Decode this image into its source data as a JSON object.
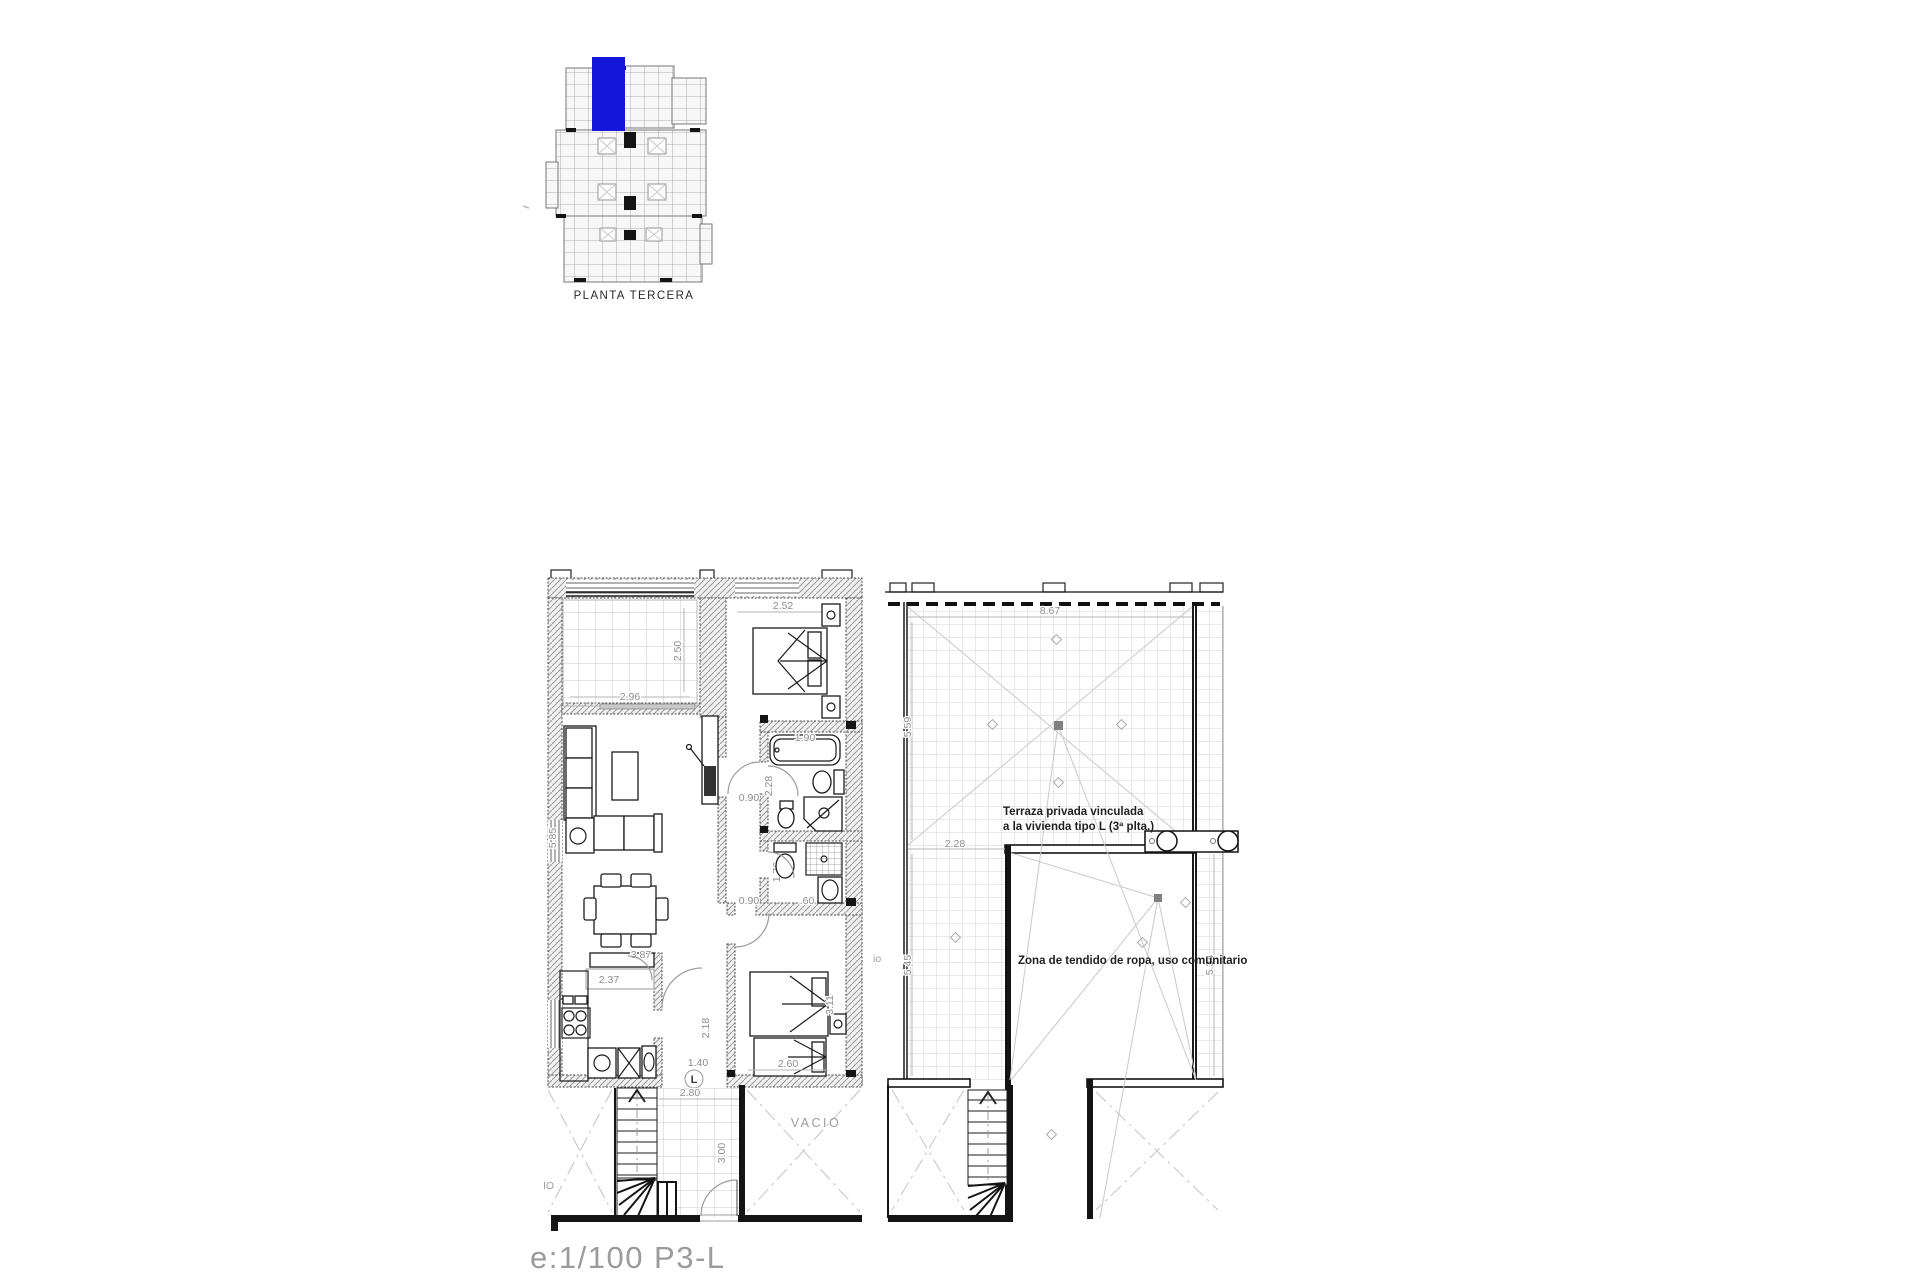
{
  "colors": {
    "highlight": "#1417d8"
  },
  "key_plan": {
    "label": "PLANTA TERCERA"
  },
  "scale_bar": {
    "label": "e:1/100  P3-L"
  },
  "apartment": {
    "dims": {
      "bedroom1_width": "2.52",
      "terrace_depth": "2.50",
      "terrace_width": "2.96",
      "living_height": "5.85",
      "bathtub": "1.90",
      "bathroom1_depth": "2.28",
      "hall_door": "0.90",
      "bathroom2_depth": "1.76",
      "bathroom2_door": "0.90",
      "basin": ".60",
      "hall_depth": "2.18",
      "hall_width": "1.40",
      "kitchen_width": "3.87",
      "kitchen_counter": "2.37",
      "bedroom2_width": "2.60",
      "bedroom2_depth": "3.11",
      "stairs_width": "2.80",
      "stairs_depth": "3.00"
    },
    "labels": {
      "void_right": "VACIO",
      "void_left_partial": "IO",
      "unit_type": "L"
    }
  },
  "terrace_plan": {
    "dims": {
      "top_width": "8.67",
      "left_upper": "5.59",
      "left_offset": "2.28",
      "left_lower": "5.45",
      "right_lower": "5.34"
    },
    "labels": {
      "edge_partial": "io"
    },
    "notes": {
      "private_line1": "Terraza privada vinculada",
      "private_line2": "a la vivienda tipo L (3ª plta.)",
      "communal": "Zona de tendido de ropa, uso comunitario"
    }
  }
}
